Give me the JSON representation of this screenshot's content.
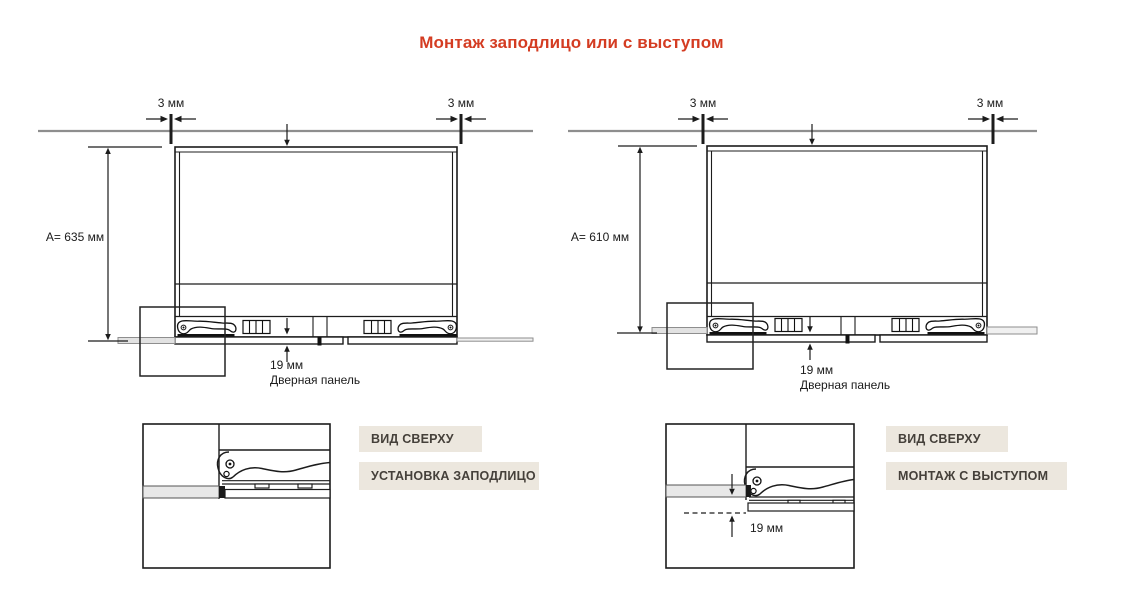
{
  "title": "Монтаж заподлицо или с выступом",
  "colors": {
    "accent_red": "#d43c22",
    "tag_background": "#ece7de",
    "tag_text": "#45403a",
    "line_black": "#1c1c1c",
    "line_gray": "#8e8e8e"
  },
  "left": {
    "gap_left": "3 мм",
    "gap_right": "3 мм",
    "top_inset": "9 мм",
    "height": "A= 635 мм",
    "thickness": "19 мм",
    "caption": "Дверная панель",
    "view_tag": "ВИД СВЕРХУ",
    "mode_tag": "УСТАНОВКА ЗАПОДЛИЦО"
  },
  "right": {
    "gap_left": "3 мм",
    "gap_right": "3 мм",
    "top_inset": "3 мм",
    "height": "A= 610 мм",
    "thickness": "19 мм",
    "caption": "Дверная панель",
    "detail_offset": "19 мм",
    "view_tag": "ВИД СВЕРХУ",
    "mode_tag": "МОНТАЖ С ВЫСТУПОМ"
  }
}
